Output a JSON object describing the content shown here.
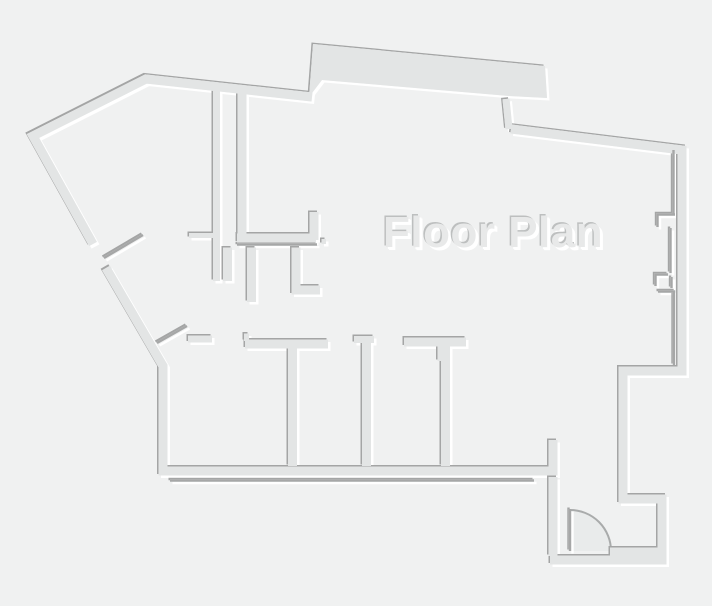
{
  "canvas": {
    "width": 712,
    "height": 606,
    "kind": "floor-plan-drawing"
  },
  "title": {
    "text": "Floor Plan"
  },
  "colors": {
    "background": "#f0f1f1",
    "wall_fill": "#e3e5e5",
    "wall_edge_dark": "#a4a5a5",
    "wall_edge_highlight": "#ffffff",
    "thin_wall_line": "#a6a7a7",
    "door_arc_stroke": "#a9abab",
    "door_swing_fill": "#e9ebeb",
    "title_fill": "#e8e9e9",
    "title_shadow_dark": "#bdbfbf",
    "title_shadow_light": "#ffffff"
  },
  "plan": {
    "style": "embossed-monochrome",
    "visible_features": [
      "irregular-exterior-wall-outline",
      "top-slab-protrusion",
      "interior-closet-walls",
      "four-bottom-rooms-with-dividers",
      "right-wall-utility-line-notches",
      "entry-vestibule-bottom-right",
      "entry-door-with-swing-arc",
      "two-open-door-leaves-without-arc",
      "double-line-wall-details"
    ],
    "doors": [
      {
        "name": "upper-left-diagonal-wall-door",
        "state": "open-leaf-shown"
      },
      {
        "name": "bottom-room-row-door",
        "state": "open-leaf-shown"
      },
      {
        "name": "entry-door",
        "state": "open-with-swing-arc"
      }
    ],
    "bottom_room_count": 4
  }
}
